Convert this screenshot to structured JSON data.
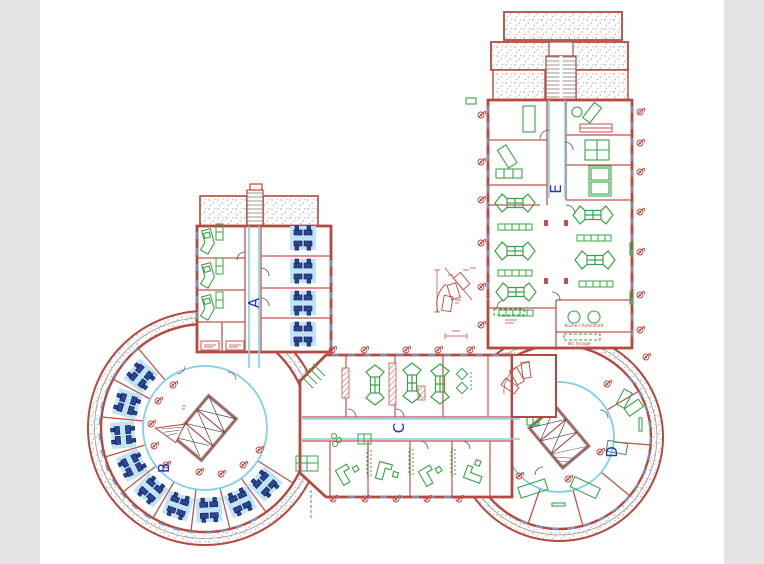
{
  "page": {
    "background": "#ffffff",
    "side_band_color": "#e5e5e5"
  },
  "palette": {
    "wall_red": "#b5493f",
    "wall_inner_red": "#c0544a",
    "wall_gray": "#999999",
    "corridor_cyan": "#7fd1e8",
    "window_blue": "#6ba3d6",
    "furniture_green": "#3aa346",
    "desk_blue": "#2e4496",
    "carpet_blue": "#bfe4f5",
    "zone_label_blue": "#2433c0",
    "marker_red": "#c0443c",
    "stipple_gray": "#9a9a9a"
  },
  "plan": {
    "zone_labels": [
      {
        "id": "A",
        "x": 254,
        "y": 303
      },
      {
        "id": "B",
        "x": 164,
        "y": 468
      },
      {
        "id": "C",
        "x": 399,
        "y": 428
      },
      {
        "id": "D",
        "x": 612,
        "y": 452
      },
      {
        "id": "E",
        "x": 556,
        "y": 189
      }
    ],
    "room_labels": [
      {
        "text": "Küche / Aufenthalt",
        "x": 584,
        "y": 327
      },
      {
        "text": "WC Anlage",
        "x": 579,
        "y": 345
      }
    ],
    "markers": [
      {
        "x": 481,
        "y": 115
      },
      {
        "x": 481,
        "y": 162
      },
      {
        "x": 481,
        "y": 200
      },
      {
        "x": 481,
        "y": 243
      },
      {
        "x": 481,
        "y": 287
      },
      {
        "x": 481,
        "y": 325
      },
      {
        "x": 640,
        "y": 112
      },
      {
        "x": 640,
        "y": 143
      },
      {
        "x": 640,
        "y": 172
      },
      {
        "x": 640,
        "y": 212
      },
      {
        "x": 640,
        "y": 252
      },
      {
        "x": 640,
        "y": 295
      },
      {
        "x": 640,
        "y": 330
      },
      {
        "x": 646,
        "y": 357
      },
      {
        "x": 332,
        "y": 350
      },
      {
        "x": 364,
        "y": 350
      },
      {
        "x": 406,
        "y": 350
      },
      {
        "x": 438,
        "y": 350
      },
      {
        "x": 470,
        "y": 350
      },
      {
        "x": 333,
        "y": 499
      },
      {
        "x": 365,
        "y": 499
      },
      {
        "x": 396,
        "y": 499
      },
      {
        "x": 427,
        "y": 499
      },
      {
        "x": 459,
        "y": 499
      },
      {
        "x": 166,
        "y": 465
      },
      {
        "x": 154,
        "y": 446
      },
      {
        "x": 151,
        "y": 424
      },
      {
        "x": 158,
        "y": 401
      },
      {
        "x": 173,
        "y": 385
      },
      {
        "x": 199,
        "y": 472
      },
      {
        "x": 221,
        "y": 474
      },
      {
        "x": 243,
        "y": 465
      },
      {
        "x": 259,
        "y": 450
      },
      {
        "x": 607,
        "y": 384
      },
      {
        "x": 600,
        "y": 452
      },
      {
        "x": 568,
        "y": 479
      },
      {
        "x": 519,
        "y": 476
      }
    ],
    "desk_clusters": [
      {
        "x": 303,
        "y": 238,
        "rot": 0
      },
      {
        "x": 303,
        "y": 271,
        "rot": 0
      },
      {
        "x": 303,
        "y": 303,
        "rot": 0
      },
      {
        "x": 303,
        "y": 334,
        "rot": 0
      },
      {
        "x": 141,
        "y": 376,
        "rot": 309
      },
      {
        "x": 127,
        "y": 404,
        "rot": 287
      },
      {
        "x": 123,
        "y": 435,
        "rot": 265
      },
      {
        "x": 132,
        "y": 465,
        "rot": 243
      },
      {
        "x": 151,
        "y": 490,
        "rot": 221
      },
      {
        "x": 178,
        "y": 506,
        "rot": 199
      },
      {
        "x": 209,
        "y": 510,
        "rot": 177
      },
      {
        "x": 240,
        "y": 502,
        "rot": 155
      },
      {
        "x": 265,
        "y": 484,
        "rot": 133
      }
    ],
    "arrow_tables": [
      {
        "x": 515,
        "y": 203,
        "rot": 0
      },
      {
        "x": 515,
        "y": 251,
        "rot": 0
      },
      {
        "x": 516,
        "y": 292,
        "rot": 0
      },
      {
        "x": 593,
        "y": 215,
        "rot": 0
      },
      {
        "x": 595,
        "y": 260,
        "rot": 0
      },
      {
        "x": 375,
        "y": 385,
        "rot": 90
      },
      {
        "x": 412,
        "y": 383,
        "rot": 90
      },
      {
        "x": 440,
        "y": 384,
        "rot": 90
      }
    ],
    "shelf_rows": [
      {
        "x": 515,
        "y": 227,
        "rot": 0
      },
      {
        "x": 515,
        "y": 273,
        "rot": 0
      },
      {
        "x": 516,
        "y": 313,
        "rot": 0
      },
      {
        "x": 594,
        "y": 238,
        "rot": 0
      },
      {
        "x": 596,
        "y": 284,
        "rot": 0
      }
    ],
    "l_desks": [
      {
        "x": 207,
        "y": 243,
        "rot": -15
      },
      {
        "x": 207,
        "y": 277,
        "rot": -15
      },
      {
        "x": 207,
        "y": 309,
        "rot": -15
      }
    ],
    "angled_desks": [
      {
        "x": 350,
        "y": 468,
        "rot": -30
      },
      {
        "x": 392,
        "y": 470,
        "rot": 15
      },
      {
        "x": 433,
        "y": 469,
        "rot": -30
      },
      {
        "x": 473,
        "y": 466,
        "rot": -70
      }
    ]
  }
}
